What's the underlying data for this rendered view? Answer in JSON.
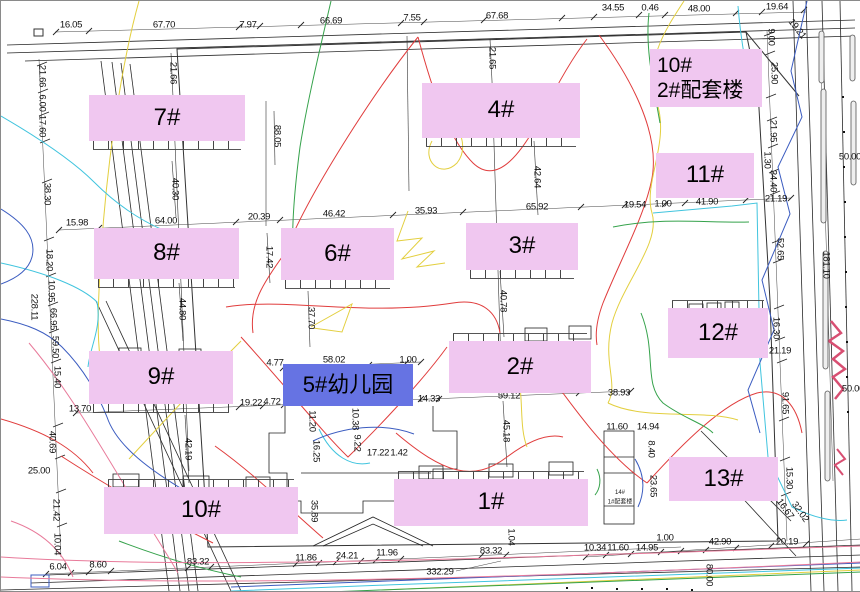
{
  "colors": {
    "label_pink": "#F0C7F0",
    "label_blue": "#6673E3",
    "dim_text": "#101010"
  },
  "buildings": [
    {
      "id": "7",
      "text": "7#",
      "type": "pink",
      "x": 88,
      "y": 94,
      "w": 156,
      "h": 46,
      "teeth": "below"
    },
    {
      "id": "4",
      "text": "4#",
      "type": "pink",
      "x": 421,
      "y": 82,
      "w": 158,
      "h": 55,
      "teeth": "below"
    },
    {
      "id": "10-2",
      "lines": [
        "10#",
        "2#配套楼"
      ],
      "type": "pink",
      "x": 649,
      "y": 48,
      "w": 112,
      "h": 58,
      "teeth": "none"
    },
    {
      "id": "11",
      "text": "11#",
      "type": "pink",
      "x": 655,
      "y": 152,
      "w": 98,
      "h": 45,
      "teeth": "none"
    },
    {
      "id": "8",
      "text": "8#",
      "type": "pink",
      "x": 93,
      "y": 227,
      "w": 145,
      "h": 51,
      "teeth": "below"
    },
    {
      "id": "6",
      "text": "6#",
      "type": "pink",
      "x": 280,
      "y": 227,
      "w": 113,
      "h": 52,
      "teeth": "below"
    },
    {
      "id": "3",
      "text": "3#",
      "type": "pink",
      "x": 465,
      "y": 222,
      "w": 112,
      "h": 47,
      "teeth": "below"
    },
    {
      "id": "12",
      "text": "12#",
      "type": "pink",
      "x": 667,
      "y": 307,
      "w": 100,
      "h": 50,
      "teeth": "above"
    },
    {
      "id": "9",
      "text": "9#",
      "type": "pink",
      "x": 88,
      "y": 350,
      "w": 144,
      "h": 53,
      "teeth": "below"
    },
    {
      "id": "5",
      "text": "5#幼儿园",
      "type": "blue",
      "x": 282,
      "y": 363,
      "w": 130,
      "h": 42,
      "teeth": "none"
    },
    {
      "id": "2",
      "text": "2#",
      "type": "pink",
      "x": 448,
      "y": 340,
      "w": 142,
      "h": 52,
      "teeth": "above"
    },
    {
      "id": "13",
      "text": "13#",
      "type": "pink",
      "x": 668,
      "y": 456,
      "w": 109,
      "h": 44,
      "teeth": "none"
    },
    {
      "id": "10b",
      "text": "10#",
      "type": "pink",
      "x": 103,
      "y": 486,
      "w": 194,
      "h": 47,
      "teeth": "above"
    },
    {
      "id": "1",
      "text": "1#",
      "type": "pink",
      "x": 393,
      "y": 478,
      "w": 194,
      "h": 47,
      "teeth": "above"
    }
  ],
  "dims_h": [
    {
      "t": "16.05",
      "x": 70,
      "y": 24
    },
    {
      "t": "67.70",
      "x": 163,
      "y": 24
    },
    {
      "t": "7.97",
      "x": 247,
      "y": 24
    },
    {
      "t": "66.69",
      "x": 330,
      "y": 20
    },
    {
      "t": "7.55",
      "x": 411,
      "y": 17
    },
    {
      "t": "67.68",
      "x": 496,
      "y": 15
    },
    {
      "t": "34.55",
      "x": 612,
      "y": 7
    },
    {
      "t": "0.46",
      "x": 649,
      "y": 7
    },
    {
      "t": "48.00",
      "x": 698,
      "y": 8
    },
    {
      "t": "19.64",
      "x": 776,
      "y": 6
    },
    {
      "t": "15.98",
      "x": 76,
      "y": 222
    },
    {
      "t": "64.00",
      "x": 165,
      "y": 220
    },
    {
      "t": "20.39",
      "x": 258,
      "y": 216
    },
    {
      "t": "46.42",
      "x": 333,
      "y": 213
    },
    {
      "t": "35.93",
      "x": 425,
      "y": 210
    },
    {
      "t": "65.92",
      "x": 536,
      "y": 206
    },
    {
      "t": "19.54",
      "x": 634,
      "y": 204
    },
    {
      "t": "1.00",
      "x": 662,
      "y": 203
    },
    {
      "t": "41.90",
      "x": 706,
      "y": 201
    },
    {
      "t": "21.19",
      "x": 775,
      "y": 198
    },
    {
      "t": "13.70",
      "x": 79,
      "y": 408
    },
    {
      "t": "19.22",
      "x": 250,
      "y": 402
    },
    {
      "t": "4.72",
      "x": 271,
      "y": 401
    },
    {
      "t": "4.77",
      "x": 274,
      "y": 362
    },
    {
      "t": "58.02",
      "x": 333,
      "y": 359
    },
    {
      "t": "1.00",
      "x": 407,
      "y": 359
    },
    {
      "t": "14.33",
      "x": 428,
      "y": 398
    },
    {
      "t": "59.12",
      "x": 508,
      "y": 395
    },
    {
      "t": "38.93",
      "x": 618,
      "y": 392
    },
    {
      "t": "25.00",
      "x": 38,
      "y": 470
    },
    {
      "t": "17.22",
      "x": 377,
      "y": 452
    },
    {
      "t": "1.42",
      "x": 398,
      "y": 452
    },
    {
      "t": "11.60",
      "x": 616,
      "y": 426
    },
    {
      "t": "14.94",
      "x": 647,
      "y": 426
    },
    {
      "t": "21.19",
      "x": 779,
      "y": 350
    },
    {
      "t": "50.00",
      "x": 849,
      "y": 156
    },
    {
      "t": "50.00",
      "x": 852,
      "y": 388
    },
    {
      "t": "6.04",
      "x": 57,
      "y": 566
    },
    {
      "t": "8.60",
      "x": 97,
      "y": 564
    },
    {
      "t": "83.32",
      "x": 197,
      "y": 561
    },
    {
      "t": "11.86",
      "x": 305,
      "y": 557
    },
    {
      "t": "24.21",
      "x": 346,
      "y": 555
    },
    {
      "t": "11.96",
      "x": 386,
      "y": 552
    },
    {
      "t": "83.32",
      "x": 490,
      "y": 550
    },
    {
      "t": "332.29",
      "x": 439,
      "y": 571
    },
    {
      "t": "10.34",
      "x": 594,
      "y": 547
    },
    {
      "t": "11.60",
      "x": 617,
      "y": 547
    },
    {
      "t": "14.95",
      "x": 646,
      "y": 547
    },
    {
      "t": "1.00",
      "x": 664,
      "y": 537
    },
    {
      "t": "42.90",
      "x": 719,
      "y": 541
    },
    {
      "t": "20.19",
      "x": 786,
      "y": 541
    }
  ],
  "dims_v": [
    {
      "t": "21.66",
      "x": 41,
      "y": 75
    },
    {
      "t": "6.00",
      "x": 41,
      "y": 102
    },
    {
      "t": "17.60",
      "x": 41,
      "y": 125
    },
    {
      "t": "38.30",
      "x": 46,
      "y": 193
    },
    {
      "t": "18.20",
      "x": 48,
      "y": 259
    },
    {
      "t": "10.95",
      "x": 50,
      "y": 290
    },
    {
      "t": "228.11",
      "x": 33,
      "y": 306
    },
    {
      "t": "66.95",
      "x": 52,
      "y": 318
    },
    {
      "t": "59.50",
      "x": 54,
      "y": 346
    },
    {
      "t": "15.40",
      "x": 56,
      "y": 376
    },
    {
      "t": "40.69",
      "x": 51,
      "y": 441
    },
    {
      "t": "21.42",
      "x": 55,
      "y": 509
    },
    {
      "t": "10.04",
      "x": 56,
      "y": 543
    },
    {
      "t": "21.66",
      "x": 172,
      "y": 72
    },
    {
      "t": "40.30",
      "x": 174,
      "y": 188
    },
    {
      "t": "88.05",
      "x": 276,
      "y": 135
    },
    {
      "t": "17.42",
      "x": 268,
      "y": 256
    },
    {
      "t": "44.80",
      "x": 181,
      "y": 308
    },
    {
      "t": "37.70",
      "x": 310,
      "y": 317
    },
    {
      "t": "21.65",
      "x": 491,
      "y": 57
    },
    {
      "t": "42.64",
      "x": 536,
      "y": 176
    },
    {
      "t": "40.78",
      "x": 502,
      "y": 300
    },
    {
      "t": "42.19",
      "x": 187,
      "y": 448
    },
    {
      "t": "45.18",
      "x": 505,
      "y": 430
    },
    {
      "t": "11.20",
      "x": 311,
      "y": 420
    },
    {
      "t": "16.25",
      "x": 315,
      "y": 450
    },
    {
      "t": "10.38",
      "x": 354,
      "y": 418
    },
    {
      "t": "9.22",
      "x": 356,
      "y": 442
    },
    {
      "t": "35.89",
      "x": 313,
      "y": 510
    },
    {
      "t": "1.04",
      "x": 510,
      "y": 536
    },
    {
      "t": "8.40",
      "x": 650,
      "y": 448
    },
    {
      "t": "23.65",
      "x": 652,
      "y": 485
    },
    {
      "t": "9.00",
      "x": 770,
      "y": 36
    },
    {
      "t": "25.90",
      "x": 773,
      "y": 72
    },
    {
      "t": "21.95",
      "x": 772,
      "y": 130
    },
    {
      "t": "1.30",
      "x": 766,
      "y": 159
    },
    {
      "t": "34.40",
      "x": 772,
      "y": 180
    },
    {
      "t": "52.65",
      "x": 779,
      "y": 248
    },
    {
      "t": "181.10",
      "x": 825,
      "y": 264
    },
    {
      "t": "16.30",
      "x": 775,
      "y": 327
    },
    {
      "t": "91.65",
      "x": 784,
      "y": 402
    },
    {
      "t": "15.30",
      "x": 788,
      "y": 477
    },
    {
      "t": "80.00",
      "x": 708,
      "y": 574
    }
  ],
  "dims_diag": [
    {
      "t": "19.21",
      "x": 796,
      "y": 28,
      "r": 52
    },
    {
      "t": "16.67",
      "x": 784,
      "y": 508,
      "r": 55
    },
    {
      "t": "32.02",
      "x": 799,
      "y": 511,
      "r": 55
    }
  ],
  "annotations": [
    {
      "t": "14#",
      "x": 619,
      "y": 492
    },
    {
      "t": "1#配套楼",
      "x": 619,
      "y": 500
    }
  ]
}
